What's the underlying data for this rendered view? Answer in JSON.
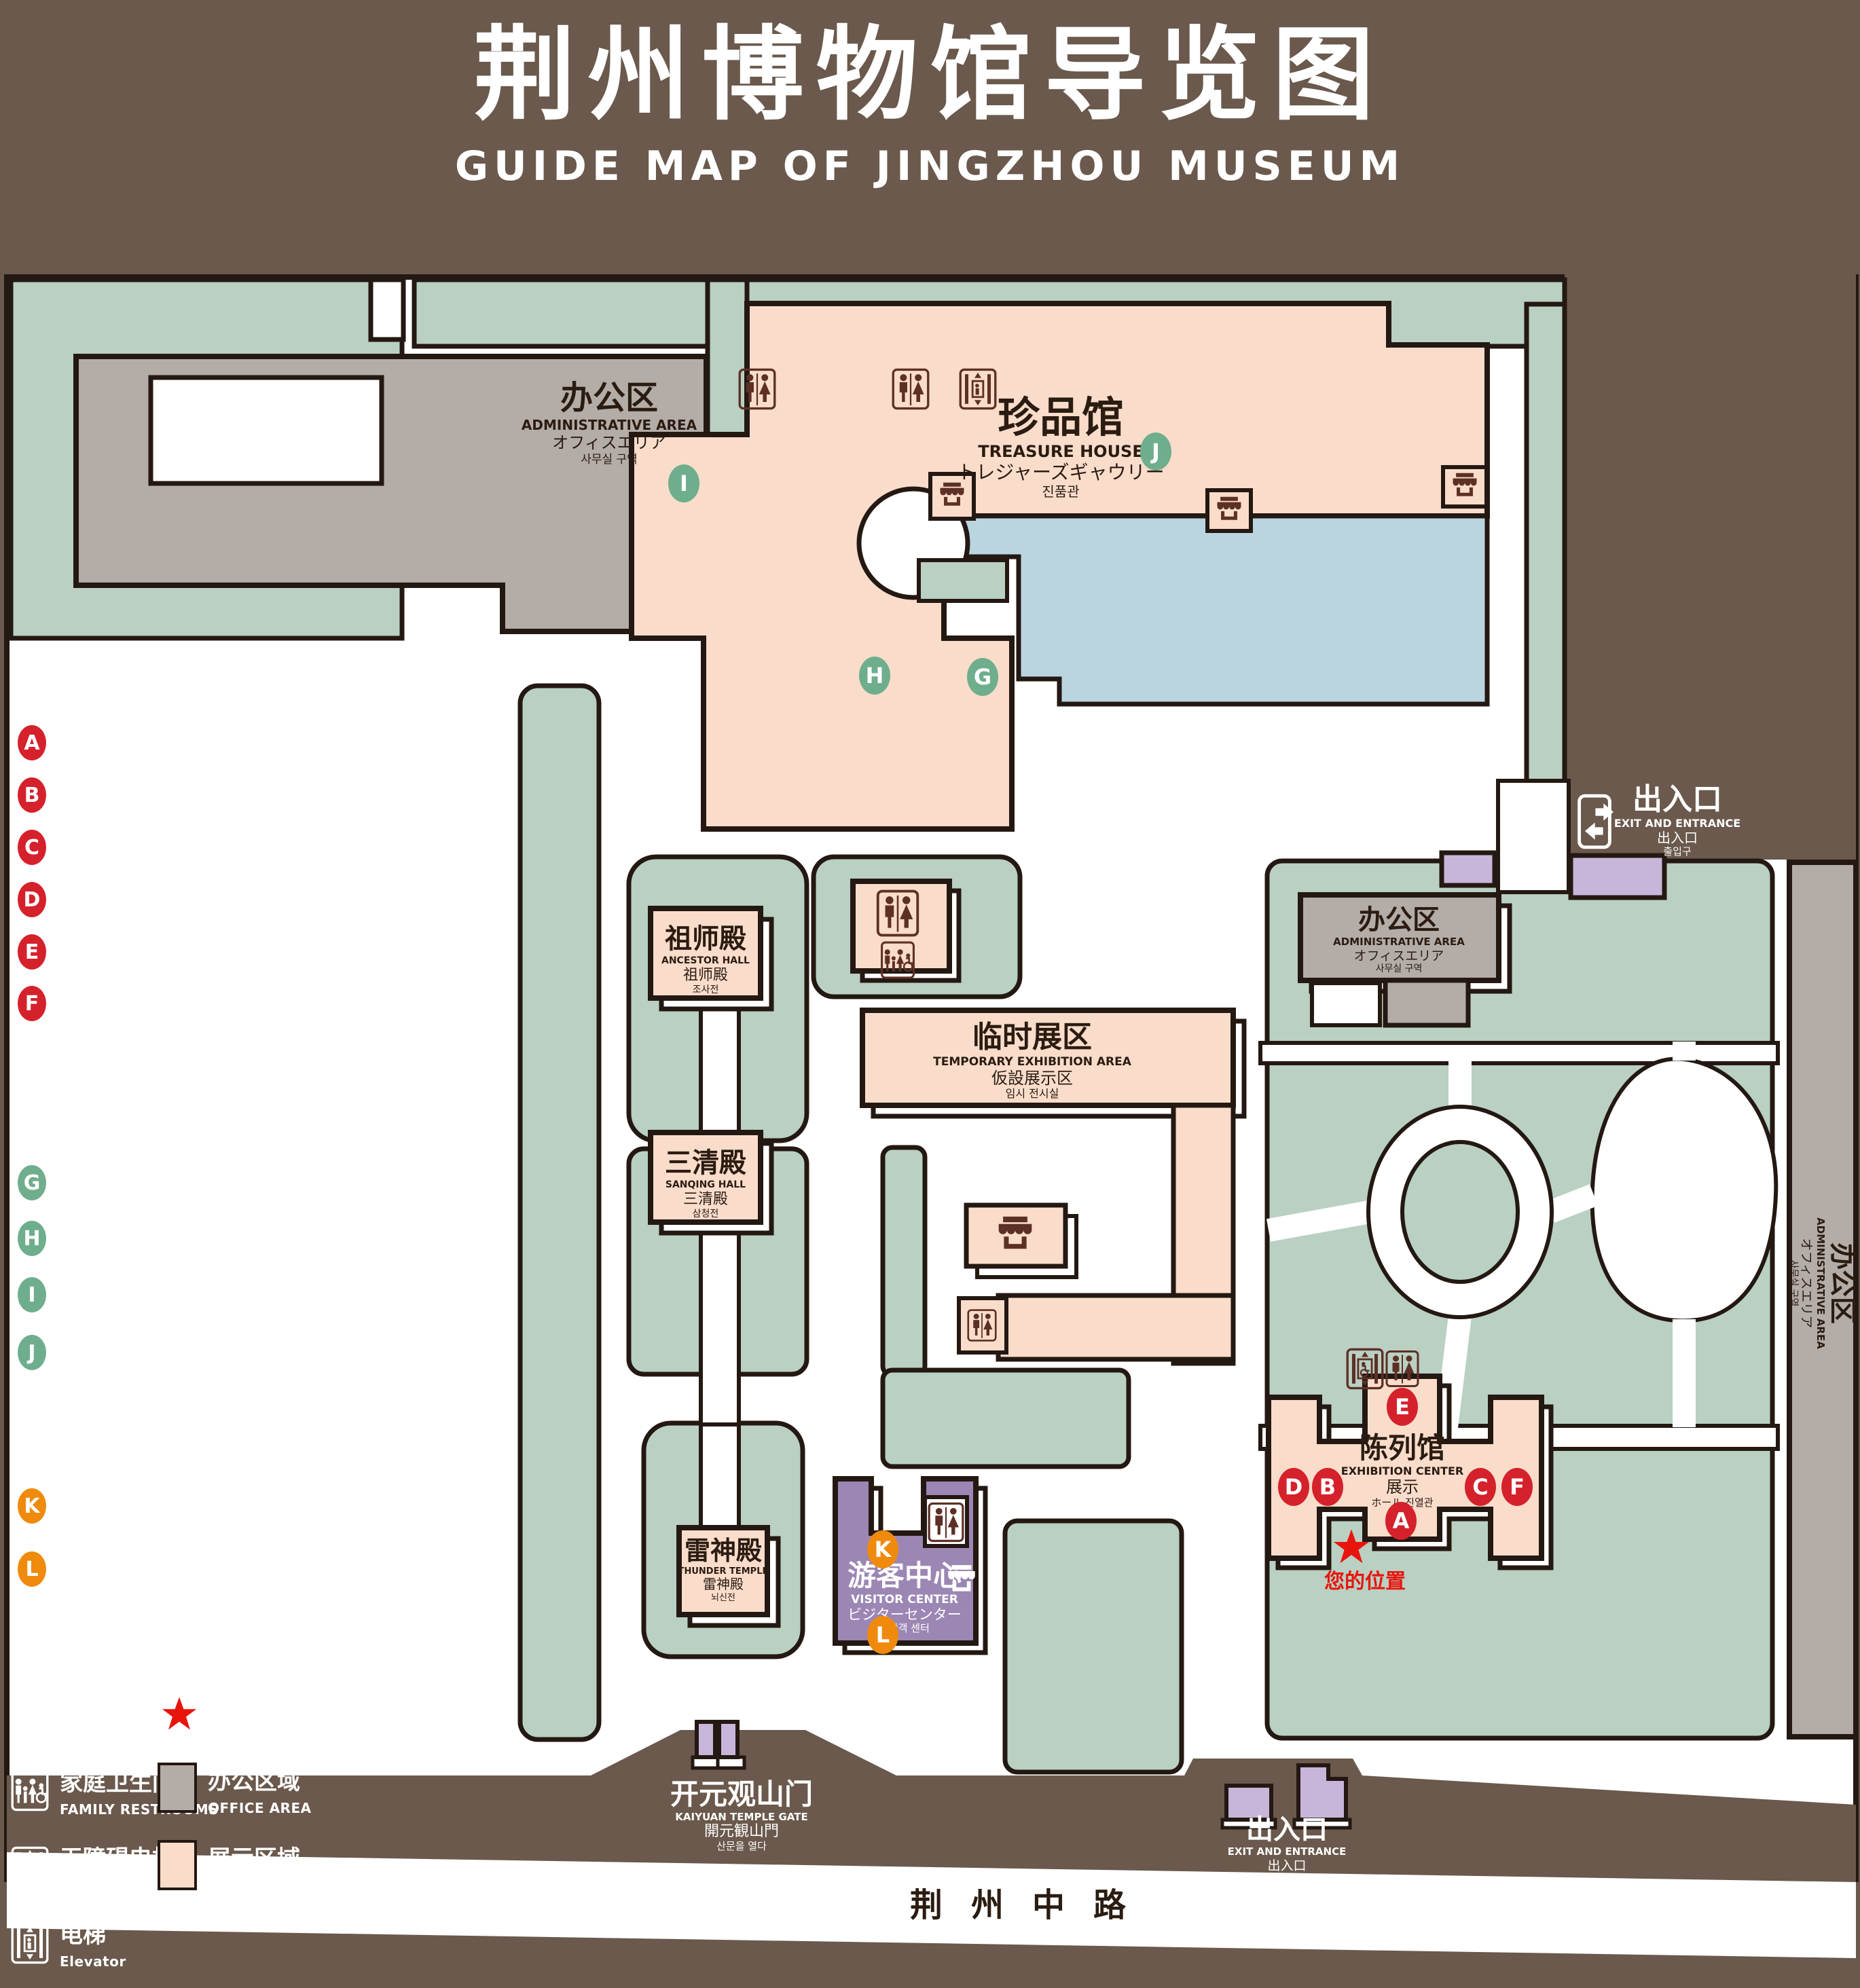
{
  "header": {
    "title": "荆州博物馆导览图",
    "subtitle": "GUIDE MAP OF JINGZHOU MUSEUM"
  },
  "colors": {
    "background_brown": "#6a594c",
    "lawn_green": "#b9d0c3",
    "display_pink": "#f9dcca",
    "office_gray": "#b3aca7",
    "water_blue": "#bad5e0",
    "visitor_purple": "#9c86b4",
    "booth_purple": "#c7b6da",
    "marker_red": "#d5212b",
    "marker_green": "#6fae8d",
    "marker_orange": "#ef8a0d",
    "icon_brown": "#5d3026",
    "location_red": "#e8150d"
  },
  "legend": {
    "sections": [
      {
        "zh": "陈列馆",
        "en": "EXHIBITION CENTER",
        "items": [
          {
            "letter": "A",
            "zh": "《火中的凤凰》壁画",
            "en": "THE PHOENIX IN FIRE \"MURAL PAINTING",
            "floor": "1F"
          },
          {
            "letter": "B",
            "zh": "荆州出土铜器展",
            "en": "JINGZHOU UNEARTHED BRONZE WARE EXHIBITION",
            "floor": "1F"
          },
          {
            "letter": "C",
            "zh": "江汉平原原始文化展",
            "en": "JIANGHAN PLAIN PRIMITIVE CULTURE EXHIBITION",
            "floor": "1F"
          },
          {
            "letter": "D",
            "zh": "荆州出土瓷器展",
            "en": "JINGZHOU UNEARTHED PORCELAIN EXHIBITIONE",
            "floor": "2F"
          },
          {
            "letter": "E",
            "zh": "荆州出土简牍展",
            "en": "JINGZHOU EXCAVATED BAMBOO SLIPS EXHIBITION",
            "floor": "2F"
          },
          {
            "letter": "F",
            "zh": "荆州出土玉器展",
            "en": "JINGZHOU UNEARTHED JADE EXHIBITION",
            "floor": "2F"
          }
        ]
      },
      {
        "zh": "珍品馆",
        "en": "TREASURE HOUSE",
        "items": [
          {
            "letter": "G",
            "zh": "放映厅",
            "en": "PROJECTION HALL",
            "floor": "1F"
          },
          {
            "letter": "H",
            "zh": "互动体验厅",
            "en": "INTERACTIVE EXPERIENCE HALL",
            "floor": "1F"
          },
          {
            "letter": "I",
            "zh": "五大夫遂——凤凰山168号汉墓展",
            "en": "WUDAFU—EXHIBITION OF NO.168 HAN TOMB FROM FENGHUANGSHAN",
            "floor": "2F"
          },
          {
            "letter": "J",
            "zh": "丹漆神韵——楚秦汉漆器精品展",
            "en": "ROMANTIC CHARM OF THE CRIMSON LACQUERS—EXHIBITIONS\nOF FINE LACQUERS FROM CHU,QIN AND HAN DYNASTIES",
            "floor": "1-2F"
          }
        ]
      },
      {
        "zh": "游客中心",
        "en": "VISITOR CENTER",
        "items": [
          {
            "letter": "K",
            "zh": "安全保卫",
            "en": "SECURITY",
            "floor": "1F"
          },
          {
            "letter": "L",
            "zh": "医疗点",
            "en": "CLINIC",
            "floor": "1F"
          }
        ]
      }
    ],
    "icons": [
      {
        "name": "store-icon",
        "zh": "文创商店",
        "en": "STORE"
      },
      {
        "name": "exit-icon",
        "zh": "出入口",
        "en": "EXIT AND ENTRANCE"
      },
      {
        "name": "restroom-icon",
        "zh": "卫生间",
        "en": "RESTROOMS"
      },
      {
        "name": "location-star-icon",
        "zh": "您的位置",
        "en": "YOUR LOCATION"
      },
      {
        "name": "family-restroom-icon",
        "zh": "家庭卫生间",
        "en": "FAMILY RESTROOMS"
      },
      {
        "name": "office-area-swatch",
        "zh": "办公区域",
        "en": "OFFICE AREA"
      },
      {
        "name": "accessible-elevator-icon",
        "zh": "无障碍电梯",
        "en": "ACCESSIBLE ELEVATOR"
      },
      {
        "name": "display-area-swatch",
        "zh": "展示区域",
        "en": "DISPLAY AREA"
      },
      {
        "name": "elevator-icon",
        "zh": "电梯",
        "en": "Elevator"
      }
    ]
  },
  "map": {
    "labels": {
      "treasure": {
        "zh": "珍品馆",
        "en": "TREASURE HOUSE",
        "ja": "トレジャーズギャウリー",
        "ko": "진품관"
      },
      "admin": {
        "zh": "办公区",
        "en": "ADMINISTRATIVE AREA",
        "ja": "オフィスエリア",
        "ko": "사무실 구역"
      },
      "ancestor": {
        "zh": "祖师殿",
        "en": "ANCESTOR HALL",
        "zh2": "祖师殿",
        "ko": "조사전"
      },
      "sanqing": {
        "zh": "三清殿",
        "en": "SANQING HALL",
        "zh2": "三清殿",
        "ko": "삼청전"
      },
      "thunder": {
        "zh": "雷神殿",
        "en": "THUNDER TEMPLE",
        "zh2": "雷神殿",
        "ko": "뇌신전"
      },
      "temporary": {
        "zh": "临时展区",
        "en": "TEMPORARY EXHIBITION AREA",
        "ja": "仮設展示区",
        "ko": "임시 전시실"
      },
      "visitor": {
        "zh": "游客中心",
        "en": "VISITOR CENTER",
        "ja": "ビジターセンター",
        "ko": "관광객 센터"
      },
      "exhibition": {
        "zh": "陈列馆",
        "en": "EXHIBITION CENTER",
        "zh2": "展示",
        "mix": "ホール 진열관"
      },
      "exit": {
        "zh": "出入口",
        "en": "EXIT AND ENTRANCE",
        "zh2": "出入口",
        "ko": "출입구"
      },
      "gate": {
        "zh": "开元观山门",
        "en": "KAIYUAN TEMPLE GATE",
        "ja": "開元観山門",
        "ko": "산문을 열다"
      },
      "road": {
        "zh": "荆州中路"
      },
      "your_location": {
        "zh": "您的位置"
      }
    },
    "markers": {
      "a": "A",
      "b": "B",
      "c": "C",
      "d": "D",
      "e": "E",
      "f": "F",
      "g": "G",
      "h": "H",
      "i": "I",
      "j": "J",
      "k": "K",
      "l": "L"
    }
  }
}
